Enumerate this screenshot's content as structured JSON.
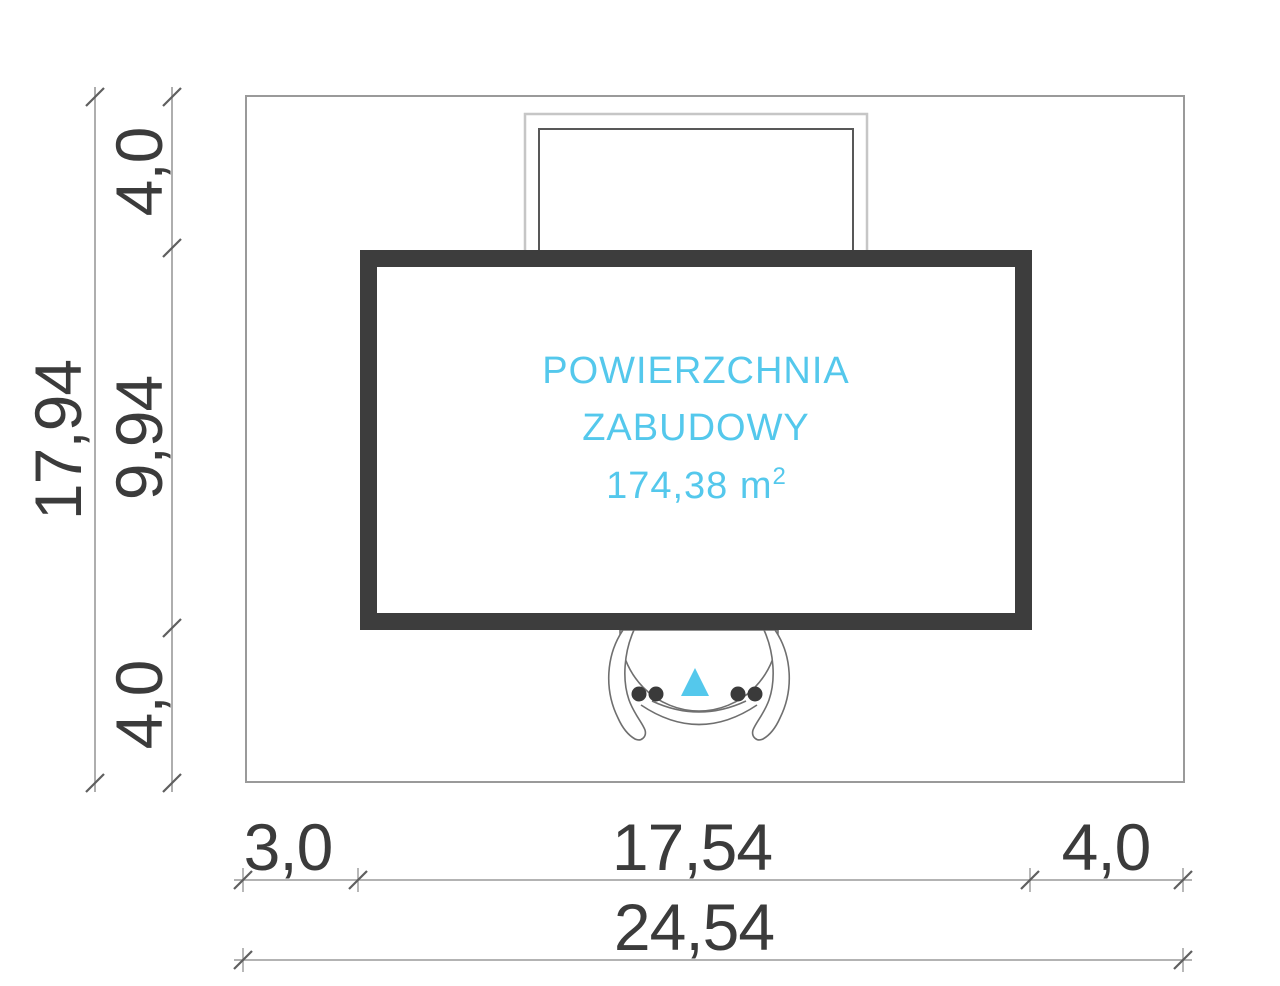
{
  "plan": {
    "area_label": {
      "line1": "POWIERZCHNIA",
      "line2": "ZABUDOWY",
      "value": "174,38 m",
      "sup": "2"
    },
    "dims": {
      "left_total": "17,94",
      "left_top": "4,0",
      "left_middle": "9,94",
      "left_bottom": "4,0",
      "bottom_left": "3,0",
      "bottom_middle": "17,54",
      "bottom_right": "4,0",
      "bottom_total": "24,54"
    },
    "colors": {
      "accent_cyan": "#54c8ec",
      "wall_dark": "#3d3d3d",
      "dim_text": "#3b3b3b",
      "thin_line": "#9a9a9a"
    }
  }
}
